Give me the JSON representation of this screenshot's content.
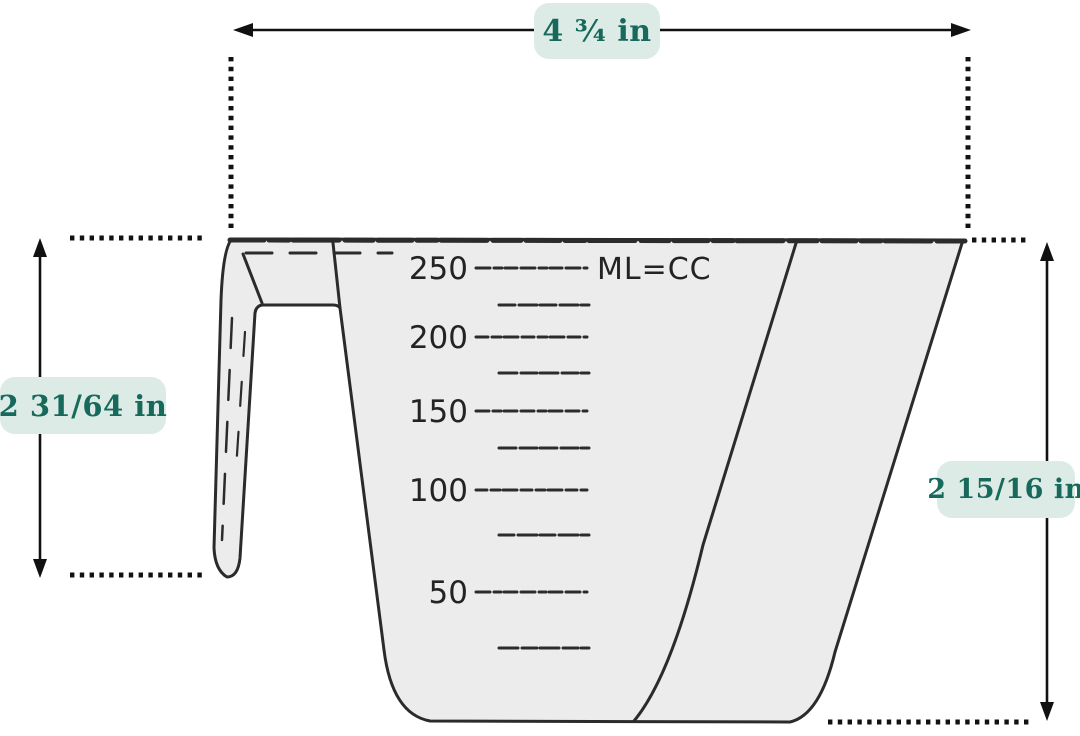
{
  "measurements": {
    "top_width": "4 ¾ in",
    "left_height": "2 31/64 in",
    "right_height": "2 15/16 in"
  },
  "cup": {
    "unit_label": "ML=CC",
    "scale_major": [
      "250",
      "200",
      "150",
      "100",
      "50"
    ]
  },
  "colors": {
    "label_bg": "#dcebe5",
    "label_text": "#17695c",
    "line_color": "#1a1a1a",
    "cup_fill": "#ececec",
    "cup_stroke": "#2b2b2b"
  }
}
